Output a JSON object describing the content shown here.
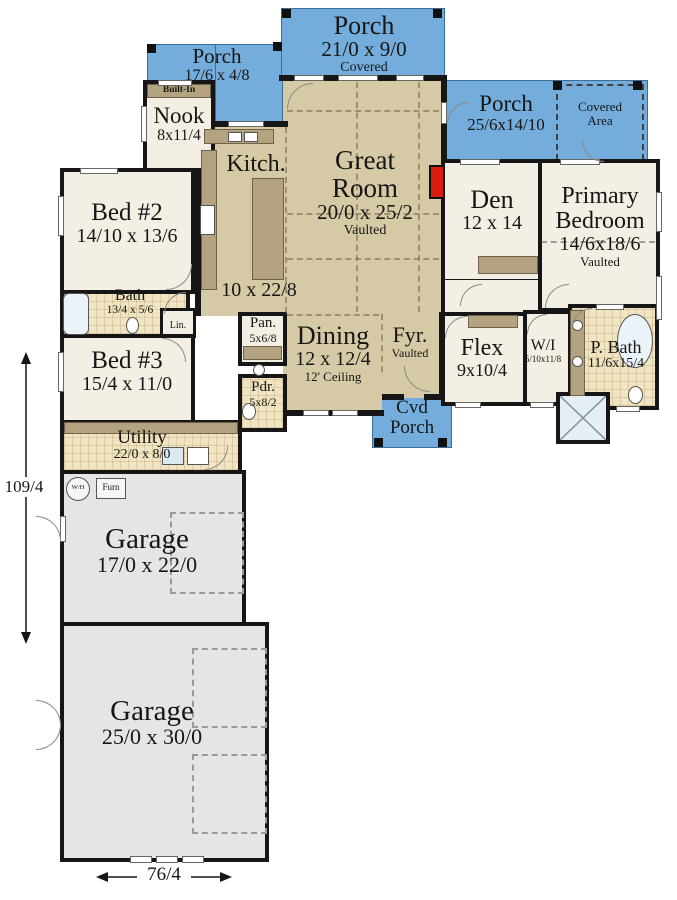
{
  "plan": {
    "porch_top": {
      "name": "Porch",
      "dims": "21/0 x 9/0",
      "note": "Covered"
    },
    "porch_left": {
      "name": "Porch",
      "dims": "17/6 x 4/8"
    },
    "porch_right": {
      "name": "Porch",
      "dims": "25/6x14/10"
    },
    "covered_area": {
      "line1": "Covered",
      "line2": "Area"
    },
    "built_in": {
      "name": "Built-In"
    },
    "nook": {
      "name": "Nook",
      "dims": "8x11/4"
    },
    "kitchen": {
      "name": "Kitch.",
      "dims": "10 x 22/8"
    },
    "great_room": {
      "line1": "Great",
      "line2": "Room",
      "dims": "20/0 x 25/2",
      "note": "Vaulted"
    },
    "bed2": {
      "name": "Bed #2",
      "dims": "14/10 x 13/6"
    },
    "bath": {
      "name": "Bath",
      "dims": "13/4 x 5/6"
    },
    "linen": {
      "name": "Lin."
    },
    "bed3": {
      "name": "Bed #3",
      "dims": "15/4 x 11/0"
    },
    "utility": {
      "name": "Utility",
      "dims": "22/0 x 8/0"
    },
    "pantry": {
      "name": "Pan.",
      "dims": "5x6/8"
    },
    "dining": {
      "name": "Dining",
      "dims": "12 x 12/4",
      "note": "12' Ceiling"
    },
    "powder": {
      "name": "Pdr.",
      "dims": "5x8/2"
    },
    "foyer": {
      "name": "Fyr.",
      "note": "Vaulted"
    },
    "cvd_porch": {
      "line1": "Cvd",
      "line2": "Porch"
    },
    "den": {
      "name": "Den",
      "dims": "12 x 14"
    },
    "primary": {
      "line1": "Primary",
      "line2": "Bedroom",
      "dims": "14/6x18/6",
      "note": "Vaulted"
    },
    "flex": {
      "name": "Flex",
      "dims": "9x10/4"
    },
    "walk_in": {
      "name": "W/I",
      "dims": "5/10x11/8"
    },
    "p_bath": {
      "name": "P. Bath",
      "dims": "11/6x15/4"
    },
    "garage1": {
      "name": "Garage",
      "dims": "17/0 x 22/0"
    },
    "garage2": {
      "name": "Garage",
      "dims": "25/0 x 30/0"
    },
    "equipment": {
      "water_heater": "W/H",
      "furnace": "Furn"
    },
    "overall": {
      "height": "109/4",
      "width": "76/4"
    }
  },
  "colors": {
    "porch_blue": "#74ADDB",
    "floor_tan": "#D6C9A6",
    "floor_cream": "#F3EFE4",
    "tile": "#F0E4C2",
    "garage_gray": "#E5E5E7",
    "wall": "#161616",
    "cabinet": "#B3A381",
    "fireplace_red": "#DD1A10"
  }
}
